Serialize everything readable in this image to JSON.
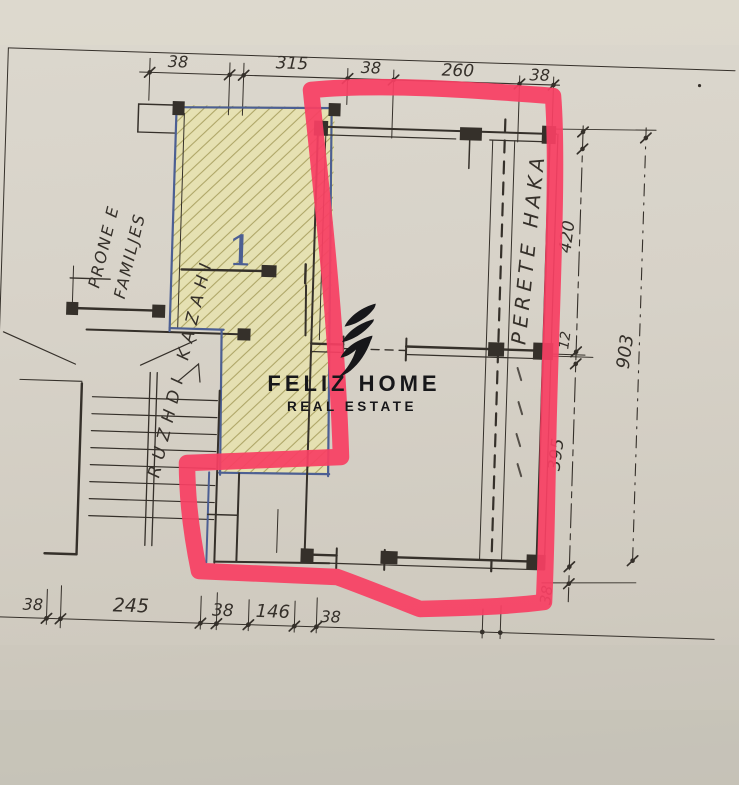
{
  "scan": {
    "dimensions_top": [
      "38",
      "315",
      "38",
      "260",
      "38"
    ],
    "dimensions_bottom": [
      "38",
      "245",
      "38",
      "146",
      "38"
    ],
    "dimensions_right_inner": [
      "420",
      "12",
      "395",
      "38"
    ],
    "dimensions_right_outer": [
      "903"
    ],
    "room_number": "1",
    "note_left_line1": "PRONE E",
    "note_left_line2": "FAMILJES",
    "note_left_line3": "RUZHDI KAZAHI",
    "note_right_wall": "PERETE HAKA"
  },
  "logo": {
    "name": "FELIZ HOME",
    "tagline": "REAL ESTATE"
  },
  "colors": {
    "paper": "#d7d2c8",
    "ink": "#35302a",
    "blue_ink": "#4c5f93",
    "hatch_fill": "#e8e3ae",
    "hatch_line": "#a89f5f",
    "highlight_pink": "#f83f63",
    "logo_black": "#17171a"
  }
}
